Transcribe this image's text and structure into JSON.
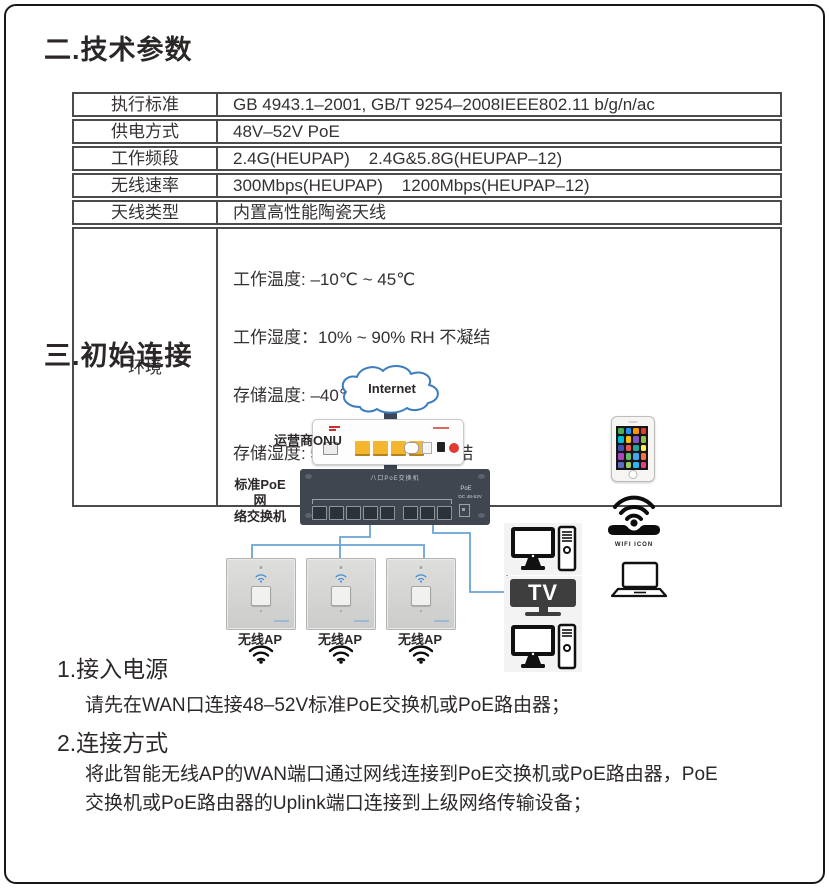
{
  "sections": {
    "tech_title": "二.技术参数",
    "connect_title": "三.初始连接"
  },
  "spec_table": {
    "rows": [
      {
        "label": "执行标准",
        "value": "GB 4943.1–2001, GB/T 9254–2008IEEE802.11 b/g/n/ac"
      },
      {
        "label": "供电方式",
        "value": "48V–52V PoE"
      },
      {
        "label": "工作频段",
        "value": "2.4G(HEUPAP)    2.4G&5.8G(HEUPAP–12)"
      },
      {
        "label": "无线速率",
        "value": "300Mbps(HEUPAP)    1200Mbps(HEUPAP–12)"
      },
      {
        "label": "天线类型",
        "value": "内置高性能陶瓷天线"
      },
      {
        "label": "环境",
        "lines": [
          "工作温度: –10℃ ~ 45℃",
          "工作湿度：10% ~ 90% RH 不凝结",
          "存储温度: –40℃ ~ 80℃",
          "存储湿度: 5% ~ 90% RH 不凝结"
        ]
      }
    ]
  },
  "diagram": {
    "internet_label": "Internet",
    "onu_label": "运营商ONU",
    "switch_label_line1": "标准PoE网",
    "switch_label_line2": "络交换机",
    "switch_panel_text": "八口PoE交换机",
    "switch_poe_text": "PoE",
    "switch_dc_text": "DC 48-52V",
    "aps": [
      {
        "label": "无线AP"
      },
      {
        "label": "无线AP"
      },
      {
        "label": "无线AP"
      }
    ],
    "tv_label": "TV",
    "wifi_icon_caption": "WIFI ICON",
    "phone": {
      "tile_colors": [
        "#4caf50",
        "#2196f3",
        "#ff9800",
        "#e53935",
        "#00bcd4",
        "#ffc107",
        "#7e57c2",
        "#8bc34a",
        "#3f51b5",
        "#ef5350",
        "#26a69a",
        "#ffee58",
        "#ab47bc",
        "#66bb6a",
        "#42a5f5",
        "#ff7043",
        "#5c6bc0",
        "#9ccc65",
        "#29b6f6",
        "#ec407a"
      ]
    }
  },
  "steps": {
    "s1_title": "1.接入电源",
    "s1_body": "请先在WAN口连接48–52V标准PoE交换机或PoE路由器；",
    "s2_title": "2.连接方式",
    "s2_lines": [
      "将此智能无线AP的WAN端口通过网线连接到PoE交换机或PoE路由器，PoE",
      "交换机或PoE路由器的Uplink端口连接到上级网络传输设备；"
    ]
  },
  "colors": {
    "text": "#2c2829",
    "wire_blue": "#6ba3d6",
    "trunk_dark": "#3c4757",
    "switch_bg": "#404650",
    "onu_port_yellow": "#f4b62e",
    "onu_button_red": "#e23a2e",
    "cloud_blue": "#3c7dc0",
    "ap_wifi_blue": "#3f8ed2",
    "tv_dark": "#3e3e3e"
  }
}
